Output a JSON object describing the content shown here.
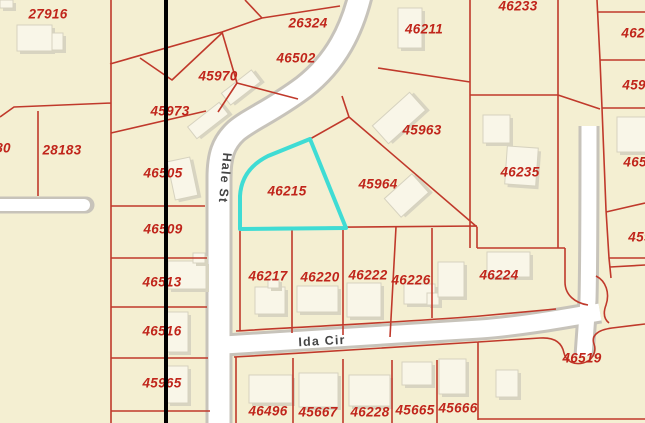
{
  "map": {
    "selected_parcel": "46215",
    "colors": {
      "bg": "#F4EFD2",
      "line": "#C0392B",
      "label": "#C0251B",
      "highlight": "#3FDCD4",
      "road": "#FFFFFF",
      "casing": "#C7C3BA",
      "street": "#454545",
      "black": "#000000",
      "building": "#F9F6E8",
      "bshadow": "#D8D4C1",
      "bstroke": "#D6D2BF"
    },
    "streets": [
      {
        "name": "Hale St",
        "x": 225,
        "y": 178,
        "rotation": 95
      },
      {
        "name": "Ida Cir",
        "x": 322,
        "y": 341,
        "rotation": -3
      }
    ],
    "parcel_labels": [
      {
        "id": "27916",
        "x": 48,
        "y": 14
      },
      {
        "id": "26324",
        "x": 308,
        "y": 23
      },
      {
        "id": "46502",
        "x": 296,
        "y": 58
      },
      {
        "id": "45970",
        "x": 218,
        "y": 76
      },
      {
        "id": "45973",
        "x": 170,
        "y": 111
      },
      {
        "id": "28183",
        "x": 62,
        "y": 150
      },
      {
        "id": "80",
        "x": 3,
        "y": 148,
        "partial": true
      },
      {
        "id": "46505",
        "x": 163,
        "y": 173
      },
      {
        "id": "46509",
        "x": 163,
        "y": 229
      },
      {
        "id": "46513",
        "x": 162,
        "y": 282
      },
      {
        "id": "46516",
        "x": 162,
        "y": 331
      },
      {
        "id": "45965",
        "x": 162,
        "y": 383
      },
      {
        "id": "46215",
        "x": 287,
        "y": 191
      },
      {
        "id": "45963",
        "x": 422,
        "y": 130
      },
      {
        "id": "45964",
        "x": 378,
        "y": 184
      },
      {
        "id": "46211",
        "x": 424,
        "y": 29
      },
      {
        "id": "46233",
        "x": 518,
        "y": 6
      },
      {
        "id": "46235",
        "x": 520,
        "y": 172
      },
      {
        "id": "46224",
        "x": 499,
        "y": 275
      },
      {
        "id": "46217",
        "x": 268,
        "y": 276
      },
      {
        "id": "46220",
        "x": 320,
        "y": 277
      },
      {
        "id": "46222",
        "x": 368,
        "y": 275
      },
      {
        "id": "46226",
        "x": 411,
        "y": 280
      },
      {
        "id": "46496",
        "x": 268,
        "y": 411
      },
      {
        "id": "45667",
        "x": 318,
        "y": 412
      },
      {
        "id": "46228",
        "x": 370,
        "y": 412
      },
      {
        "id": "45665",
        "x": 415,
        "y": 410
      },
      {
        "id": "45666",
        "x": 458,
        "y": 408
      },
      {
        "id": "46519",
        "x": 582,
        "y": 358
      },
      {
        "id": "4623",
        "x": 637,
        "y": 33,
        "partial": true
      },
      {
        "id": "4596",
        "x": 638,
        "y": 85,
        "partial": true
      },
      {
        "id": "4652",
        "x": 639,
        "y": 162,
        "partial": true
      },
      {
        "id": "459",
        "x": 640,
        "y": 237,
        "partial": true
      }
    ],
    "buildings": [
      {
        "x": 17,
        "y": 25,
        "w": 35,
        "h": 26,
        "r": 0
      },
      {
        "x": 52,
        "y": 33,
        "w": 11,
        "h": 17,
        "r": 0
      },
      {
        "x": 0,
        "y": 0,
        "w": 13,
        "h": 8,
        "r": 0
      },
      {
        "x": 222,
        "y": 80,
        "w": 38,
        "h": 15,
        "r": -38
      },
      {
        "x": 188,
        "y": 113,
        "w": 40,
        "h": 15,
        "r": -38
      },
      {
        "x": 171,
        "y": 159,
        "w": 23,
        "h": 39,
        "r": -12
      },
      {
        "x": 398,
        "y": 8,
        "w": 24,
        "h": 40,
        "r": 0
      },
      {
        "x": 483,
        "y": 115,
        "w": 27,
        "h": 28,
        "r": 0
      },
      {
        "x": 506,
        "y": 147,
        "w": 31,
        "h": 38,
        "r": 4
      },
      {
        "x": 374,
        "y": 106,
        "w": 50,
        "h": 24,
        "r": -42
      },
      {
        "x": 388,
        "y": 183,
        "w": 37,
        "h": 25,
        "r": -42
      },
      {
        "x": 168,
        "y": 261,
        "w": 38,
        "h": 28,
        "r": 0
      },
      {
        "x": 193,
        "y": 253,
        "w": 12,
        "h": 10,
        "r": 0
      },
      {
        "x": 166,
        "y": 312,
        "w": 22,
        "h": 40,
        "r": 0
      },
      {
        "x": 167,
        "y": 366,
        "w": 21,
        "h": 37,
        "r": 0
      },
      {
        "x": 255,
        "y": 287,
        "w": 30,
        "h": 27,
        "r": 0
      },
      {
        "x": 268,
        "y": 279,
        "w": 11,
        "h": 9,
        "r": 0
      },
      {
        "x": 297,
        "y": 286,
        "w": 41,
        "h": 26,
        "r": 0
      },
      {
        "x": 347,
        "y": 283,
        "w": 34,
        "h": 34,
        "r": 0
      },
      {
        "x": 404,
        "y": 284,
        "w": 31,
        "h": 20,
        "r": 0
      },
      {
        "x": 427,
        "y": 293,
        "w": 12,
        "h": 12,
        "r": 0
      },
      {
        "x": 438,
        "y": 262,
        "w": 26,
        "h": 35,
        "r": 0
      },
      {
        "x": 487,
        "y": 252,
        "w": 43,
        "h": 25,
        "r": 0
      },
      {
        "x": 249,
        "y": 375,
        "w": 43,
        "h": 28,
        "r": 0
      },
      {
        "x": 299,
        "y": 373,
        "w": 39,
        "h": 34,
        "r": 0
      },
      {
        "x": 349,
        "y": 375,
        "w": 41,
        "h": 31,
        "r": 0
      },
      {
        "x": 402,
        "y": 362,
        "w": 30,
        "h": 23,
        "r": 0
      },
      {
        "x": 439,
        "y": 359,
        "w": 27,
        "h": 35,
        "r": 0
      },
      {
        "x": 496,
        "y": 370,
        "w": 22,
        "h": 27,
        "r": 0
      },
      {
        "x": 617,
        "y": 117,
        "w": 29,
        "h": 35,
        "r": 0
      }
    ]
  }
}
